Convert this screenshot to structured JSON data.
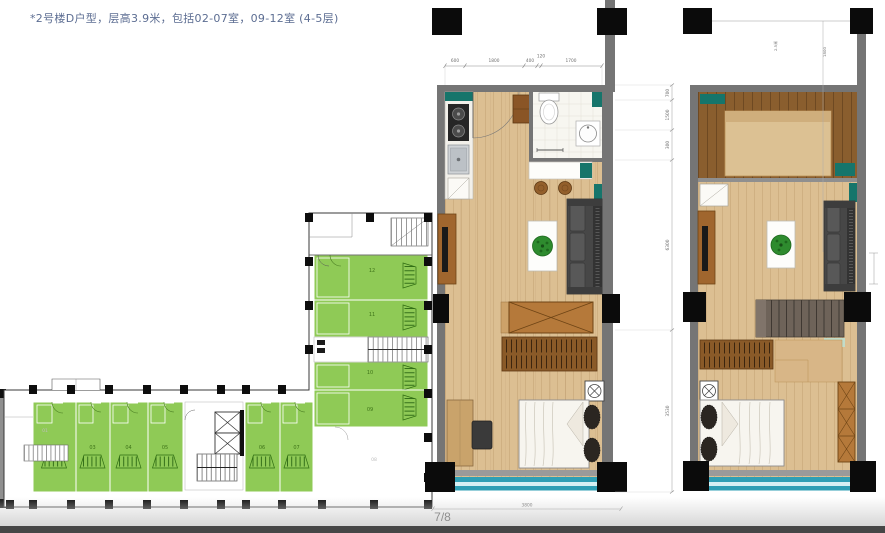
{
  "header": {
    "title": "*2号楼D户型，层高3.9米，包括02-07室，09-12室 (4-5层)"
  },
  "footer": {
    "page_indicator": "7/8"
  },
  "overview_plan": {
    "horizontal_units": [
      "02",
      "03",
      "04",
      "05",
      "06",
      "07"
    ],
    "vertical_units": [
      "12",
      "11",
      "10",
      "09"
    ],
    "excluded_units": [
      "01",
      "08"
    ]
  },
  "lower_plan": {
    "dims_top": [
      "600",
      "1800",
      "400",
      "120",
      "1700"
    ],
    "dims_right": [
      "700",
      "1500",
      "300",
      "6300",
      "3530"
    ],
    "dim_bottom": "3800"
  },
  "upper_plan": {
    "dim_notes": [
      "2.5米",
      "1800"
    ]
  },
  "colors": {
    "unit_highlight_green": "#8FCA56",
    "window_teal": "#2F9FB5",
    "wall_gray": "#757575",
    "floor_wood": "#DCBF92",
    "cabinet_teal": "#16756B",
    "title_text": "#5C6D92"
  }
}
